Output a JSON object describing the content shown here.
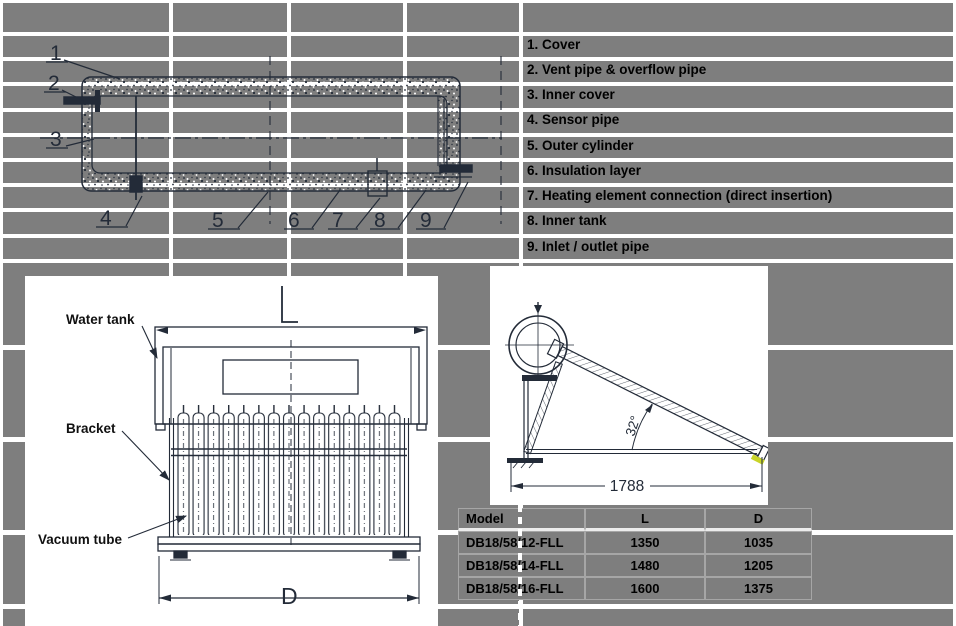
{
  "legend": {
    "items": [
      "1. Cover",
      "2. Vent pipe & overflow pipe",
      "3. Inner cover",
      "4. Sensor pipe",
      "5. Outer cylinder",
      "6. Insulation layer",
      "7. Heating element connection (direct insertion)",
      "8. Inner tank",
      "9. Inlet / outlet pipe"
    ]
  },
  "cross_section": {
    "callouts": [
      "1",
      "2",
      "3",
      "4",
      "5",
      "6",
      "7",
      "8",
      "9"
    ]
  },
  "figure_front": {
    "labels": {
      "water_tank": "Water tank",
      "bracket": "Bracket",
      "vacuum_tube": "Vacuum tube"
    },
    "dims": {
      "length": "L",
      "width": "D"
    }
  },
  "figure_side": {
    "angle": "32°",
    "base_length": "1788"
  },
  "spec_table": {
    "headers": [
      "Model",
      "L",
      "D"
    ],
    "rows": [
      {
        "model": "DB18/58/12-FLL",
        "l": "1350",
        "d": "1035"
      },
      {
        "model": "DB18/58/14-FLL",
        "l": "1480",
        "d": "1205"
      },
      {
        "model": "DB18/58/16-FLL",
        "l": "1600",
        "d": "1375"
      }
    ]
  },
  "colors": {
    "background_gray": "#7E7E7E",
    "grid_white": "#FFFFFF",
    "drawing_ink": "#232B38",
    "accent_yellow": "#C9D428"
  }
}
